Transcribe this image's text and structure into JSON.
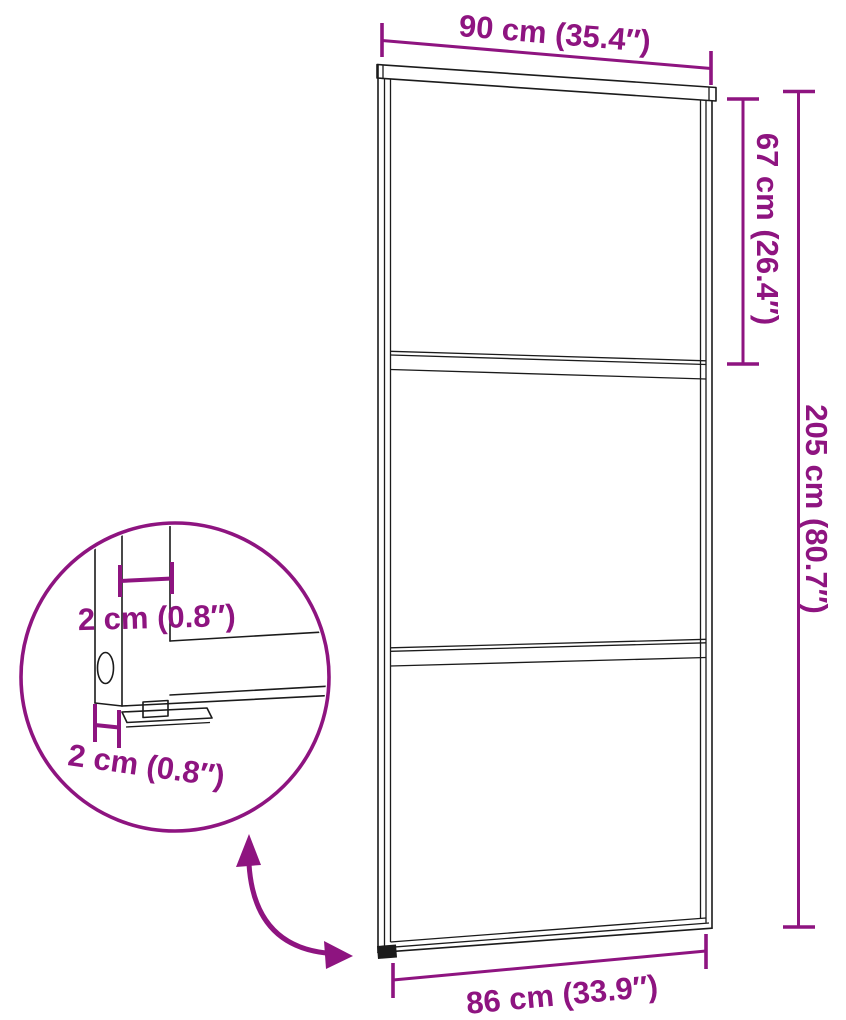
{
  "colors": {
    "dimension": "#8E1480",
    "outline": "#1b1b1b",
    "background": "#ffffff"
  },
  "diagram": {
    "type": "product-dimension-diagram",
    "subject": "sliding glass door with three glass panels, magnified bottom-corner detail"
  },
  "dimensions": {
    "top_width": "90 cm (35.4″)",
    "upper_panel_height": "67 cm (26.4″)",
    "total_height": "205 cm (80.7″)",
    "bottom_width": "86 cm (33.9″)",
    "detail_profile_depth": "2 cm (0.8″)",
    "detail_profile_width": "2 cm (0.8″)"
  }
}
